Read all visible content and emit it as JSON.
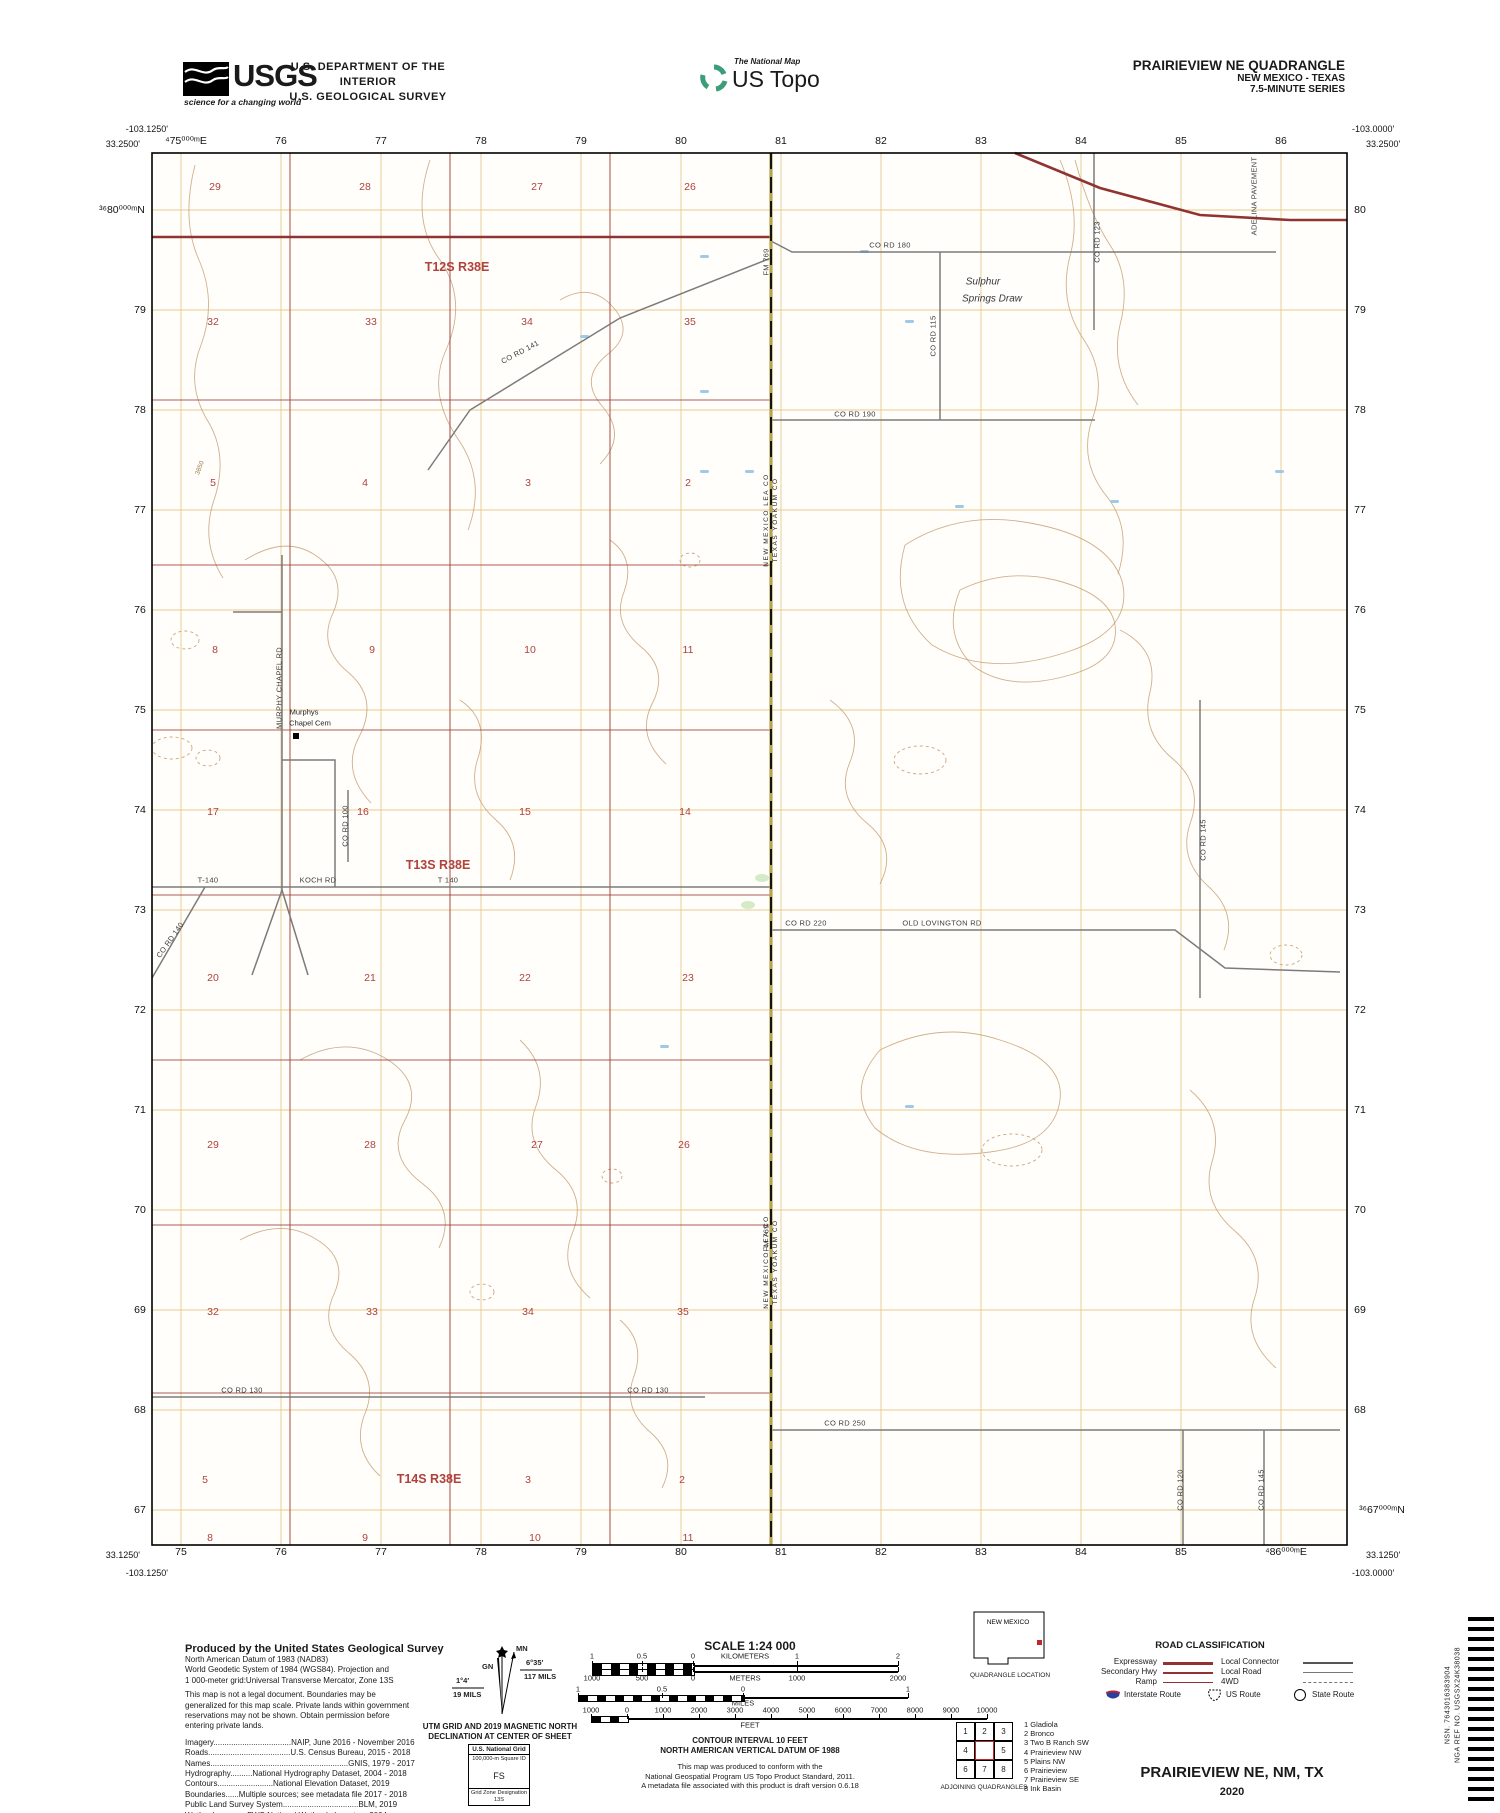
{
  "colors": {
    "topo_red": "#9e4038",
    "grid_orange": "#e4c07f",
    "contour_brown": "#c49c72",
    "road_gray": "#7b7b7b",
    "water_blue": "#9fc9e6",
    "legend_red": "#8f3431",
    "interstate_blue": "#2b3f9e",
    "logo_green": "#3c9e78",
    "black": "#111111"
  },
  "header": {
    "usgs_logo_text": "USGS",
    "usgs_tagline": "science for a changing world",
    "dept_line1": "U.S. DEPARTMENT OF THE INTERIOR",
    "dept_line2": "U.S. GEOLOGICAL SURVEY",
    "ustopo_small": "The National Map",
    "ustopo_large": "US Topo",
    "quad_title": "PRAIRIEVIEW NE QUADRANGLE",
    "quad_sub1": "NEW MEXICO - TEXAS",
    "quad_sub2": "7.5-MINUTE SERIES"
  },
  "map": {
    "corners": {
      "tl_lon": "-103.1250'",
      "tl_lat": "33.2500'",
      "tr_lon": "-103.0000'",
      "tr_lat": "33.2500'",
      "bl_lat": "33.1250'",
      "bl_lon": "-103.1250'",
      "br_lat": "33.1250'",
      "br_lon": "-103.0000'"
    },
    "ticks_top": [
      "⁴75⁰⁰⁰ᵐE",
      "76",
      "77",
      "78",
      "79",
      "80",
      "81",
      "82",
      "83",
      "84",
      "85",
      "86"
    ],
    "ticks_bottom": [
      "75",
      "76",
      "77",
      "78",
      "79",
      "80",
      "81",
      "82",
      "83",
      "84",
      "85",
      "⁴86⁰⁰⁰ᵐE"
    ],
    "ticks_left": [
      "³⁶80⁰⁰⁰ᵐN",
      "79",
      "78",
      "77",
      "76",
      "75",
      "74",
      "73",
      "72",
      "71",
      "70",
      "69",
      "68",
      "67"
    ],
    "ticks_right": [
      "80",
      "79",
      "78",
      "77",
      "76",
      "75",
      "74",
      "73",
      "72",
      "71",
      "70",
      "69",
      "68",
      "³⁶67⁰⁰⁰ᵐN"
    ],
    "township_labels": [
      {
        "t": "T12S R38E",
        "x": 457,
        "y": 267
      },
      {
        "t": "T13S R38E",
        "x": 438,
        "y": 865
      },
      {
        "t": "T14S R38E",
        "x": 429,
        "y": 1479
      }
    ],
    "section_numbers": [
      {
        "t": "29",
        "x": 215,
        "y": 187
      },
      {
        "t": "28",
        "x": 365,
        "y": 187
      },
      {
        "t": "27",
        "x": 537,
        "y": 187
      },
      {
        "t": "26",
        "x": 690,
        "y": 187
      },
      {
        "t": "32",
        "x": 213,
        "y": 322
      },
      {
        "t": "33",
        "x": 371,
        "y": 322
      },
      {
        "t": "34",
        "x": 527,
        "y": 322
      },
      {
        "t": "35",
        "x": 690,
        "y": 322
      },
      {
        "t": "5",
        "x": 213,
        "y": 483
      },
      {
        "t": "4",
        "x": 365,
        "y": 483
      },
      {
        "t": "3",
        "x": 528,
        "y": 483
      },
      {
        "t": "2",
        "x": 688,
        "y": 483
      },
      {
        "t": "8",
        "x": 215,
        "y": 650
      },
      {
        "t": "9",
        "x": 372,
        "y": 650
      },
      {
        "t": "10",
        "x": 530,
        "y": 650
      },
      {
        "t": "11",
        "x": 688,
        "y": 650
      },
      {
        "t": "17",
        "x": 213,
        "y": 812
      },
      {
        "t": "16",
        "x": 363,
        "y": 812
      },
      {
        "t": "15",
        "x": 525,
        "y": 812
      },
      {
        "t": "14",
        "x": 685,
        "y": 812
      },
      {
        "t": "20",
        "x": 213,
        "y": 978
      },
      {
        "t": "21",
        "x": 370,
        "y": 978
      },
      {
        "t": "22",
        "x": 525,
        "y": 978
      },
      {
        "t": "23",
        "x": 688,
        "y": 978
      },
      {
        "t": "29",
        "x": 213,
        "y": 1145
      },
      {
        "t": "28",
        "x": 370,
        "y": 1145
      },
      {
        "t": "27",
        "x": 537,
        "y": 1145
      },
      {
        "t": "26",
        "x": 684,
        "y": 1145
      },
      {
        "t": "32",
        "x": 213,
        "y": 1312
      },
      {
        "t": "33",
        "x": 372,
        "y": 1312
      },
      {
        "t": "34",
        "x": 528,
        "y": 1312
      },
      {
        "t": "35",
        "x": 683,
        "y": 1312
      },
      {
        "t": "5",
        "x": 205,
        "y": 1480
      },
      {
        "t": "3",
        "x": 528,
        "y": 1480
      },
      {
        "t": "2",
        "x": 682,
        "y": 1480
      },
      {
        "t": "8",
        "x": 210,
        "y": 1538
      },
      {
        "t": "9",
        "x": 365,
        "y": 1538
      },
      {
        "t": "10",
        "x": 535,
        "y": 1538
      },
      {
        "t": "11",
        "x": 688,
        "y": 1538
      }
    ],
    "road_labels": [
      {
        "t": "CO RD 180",
        "x": 890,
        "y": 245
      },
      {
        "t": "CO RD 141",
        "x": 520,
        "y": 352,
        "r": -28
      },
      {
        "t": "CO RD 190",
        "x": 855,
        "y": 414
      },
      {
        "t": "CO RD 115",
        "x": 933,
        "y": 336,
        "r": -90
      },
      {
        "t": "CO RD 123",
        "x": 1097,
        "y": 242,
        "r": -90
      },
      {
        "t": "CO RD 145",
        "x": 1203,
        "y": 840,
        "r": -90
      },
      {
        "t": "T-140",
        "x": 208,
        "y": 880
      },
      {
        "t": "KOCH RD",
        "x": 318,
        "y": 880
      },
      {
        "t": "T 140",
        "x": 448,
        "y": 880
      },
      {
        "t": "CO RD 220",
        "x": 806,
        "y": 923
      },
      {
        "t": "OLD LOVINGTON RD",
        "x": 942,
        "y": 923
      },
      {
        "t": "CO RD 130",
        "x": 242,
        "y": 1390
      },
      {
        "t": "CO RD 130",
        "x": 648,
        "y": 1390
      },
      {
        "t": "CO RD 250",
        "x": 845,
        "y": 1423
      },
      {
        "t": "CO RD 120",
        "x": 1180,
        "y": 1490,
        "r": -90
      },
      {
        "t": "CO RD 145",
        "x": 1261,
        "y": 1490,
        "r": -90
      },
      {
        "t": "MURPHY CHAPEL RD",
        "x": 279,
        "y": 688,
        "r": -90
      },
      {
        "t": "CO RD 100",
        "x": 345,
        "y": 826,
        "r": -90
      },
      {
        "t": "CO RD 140",
        "x": 170,
        "y": 940,
        "r": -55
      },
      {
        "t": "FM 769",
        "x": 766,
        "y": 262,
        "r": -90
      },
      {
        "t": "FM 769",
        "x": 766,
        "y": 1238,
        "r": -90
      },
      {
        "t": "ADELINA PAVEMENT",
        "x": 1254,
        "y": 196,
        "r": -90
      }
    ],
    "place_labels": [
      {
        "t": "Sulphur",
        "x": 983,
        "y": 282,
        "cls": "place"
      },
      {
        "t": "Springs Draw",
        "x": 992,
        "y": 299,
        "cls": "place"
      },
      {
        "t": "Murphys",
        "x": 304,
        "y": 712,
        "cls": "tiny"
      },
      {
        "t": "Chapel Cem",
        "x": 310,
        "y": 723,
        "cls": "tiny"
      }
    ],
    "state_line_label_line1": "NEW MEXICO   LEA CO",
    "state_line_label_line2": "TEXAS   YOAKUM CO",
    "contour_label": "3850"
  },
  "footer": {
    "produced_title": "Produced by the United States Geological Survey",
    "produced_lines": [
      "North American Datum of 1983 (NAD83)",
      "World Geodetic System of 1984 (WGS84).  Projection and",
      "1 000-meter grid:Universal Transverse Mercator, Zone 13S",
      "This map is not a legal document. Boundaries may be",
      "generalized for this map scale. Private lands within government",
      "reservations may not be shown. Obtain permission before",
      "entering private lands.",
      "Imagery...................................NAIP, June 2016 - November 2016",
      "Roads.....................................U.S. Census Bureau, 2015 - 2018",
      "Names..............................................................GNIS, 1979 - 2017",
      "Hydrography..........National Hydrography Dataset, 2004 - 2018",
      "Contours.........................National Elevation Dataset, 2019",
      "Boundaries......Multiple sources; see metadata file 2017 - 2018",
      "Public Land Survey System..................................BLM, 2019",
      "Wetlands.............FWS National Wetlands Inventory 2004"
    ],
    "declination": {
      "mn": "MN",
      "gn": "GN",
      "right_deg": "6°35′",
      "right_mils": "117 MILS",
      "left_deg": "1°4′",
      "left_mils": "19 MILS",
      "caption1": "UTM GRID AND 2019 MAGNETIC NORTH",
      "caption2": "DECLINATION AT CENTER OF SHEET"
    },
    "natgrid": {
      "title": "U.S. National Grid",
      "sub": "100,000-m Square ID",
      "square": "FS",
      "zone_label": "Grid Zone Designation",
      "zone": "13S"
    },
    "scale": {
      "title": "SCALE 1:24 000",
      "km": {
        "label": "KILOMETERS",
        "ticks": [
          "1",
          "0.5",
          "0",
          "1",
          "2"
        ]
      },
      "m": {
        "label": "METERS",
        "ticks": [
          "1000",
          "500",
          "0",
          "1000",
          "2000"
        ]
      },
      "mi": {
        "label": "MILES",
        "ticks": [
          "1",
          "0.5",
          "0",
          "1"
        ]
      },
      "ft": {
        "label": "FEET",
        "ticks": [
          "1000",
          "0",
          "1000",
          "2000",
          "3000",
          "4000",
          "5000",
          "6000",
          "7000",
          "8000",
          "9000",
          "10000"
        ]
      }
    },
    "contour_line1": "CONTOUR INTERVAL 10 FEET",
    "contour_line2": "NORTH AMERICAN VERTICAL DATUM OF 1988",
    "conformance": [
      "This map was produced to conform with the",
      "National Geospatial Program US Topo Product Standard, 2011.",
      "A metadata file associated with this product is draft version 0.6.18"
    ],
    "quad_location": {
      "state": "NEW MEXICO",
      "caption": "QUADRANGLE LOCATION"
    },
    "adjoining": {
      "cells": [
        "1",
        "2",
        "3",
        "4",
        "",
        "5",
        "6",
        "7",
        "8"
      ],
      "names": [
        "1 Gladiola",
        "2 Bronco",
        "3 Two B Ranch SW",
        "4 Prairieview NW",
        "5 Plains NW",
        "6 Prairieview",
        "7 Prairieview SE",
        "8 Ink Basin"
      ],
      "caption": "ADJOINING QUADRANGLES"
    },
    "road_class": {
      "title": "ROAD CLASSIFICATION",
      "left": [
        "Expressway",
        "Secondary Hwy",
        "Ramp"
      ],
      "right": [
        "Local Connector",
        "Local Road",
        "4WD"
      ],
      "shields": [
        "Interstate Route",
        "US Route",
        "State Route"
      ]
    },
    "sheet_title": "PRAIRIEVIEW NE,  NM, TX",
    "year": "2020",
    "barcode_line1": "NSN. 7643016383904",
    "barcode_line2": "NGA REF NO. USGSX24K38038"
  }
}
